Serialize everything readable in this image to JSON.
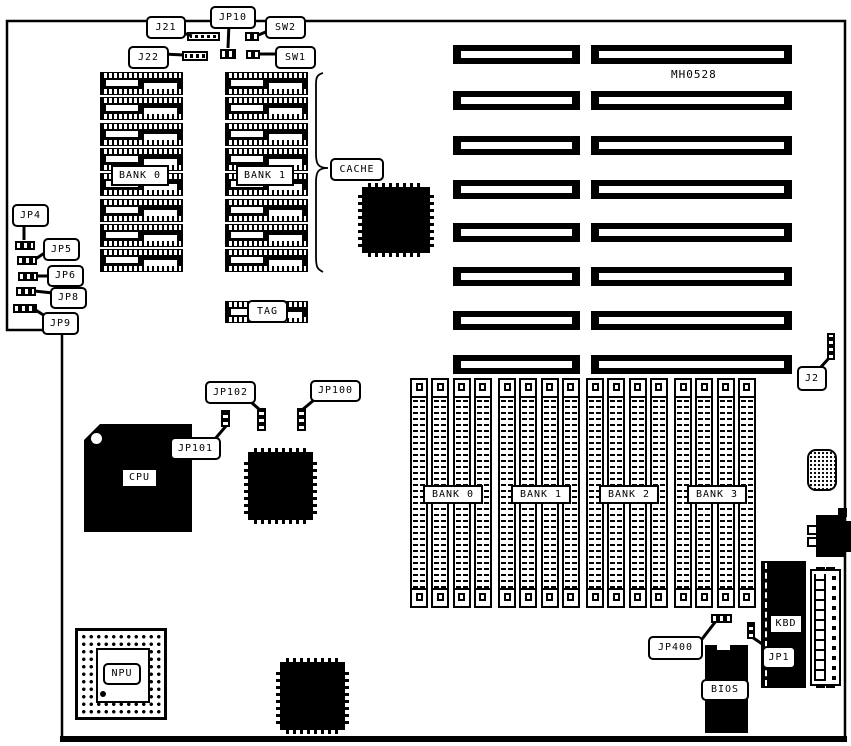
{
  "board": {
    "part_number": "MH0528",
    "callouts": {
      "j21": "J21",
      "jp10": "JP10",
      "sw2": "SW2",
      "j22": "J22",
      "sw1": "SW1",
      "jp4": "JP4",
      "jp5": "JP5",
      "jp6": "JP6",
      "jp8": "JP8",
      "jp9": "JP9",
      "cache": "CACHE",
      "jp102": "JP102",
      "jp100": "JP100",
      "jp101": "JP101",
      "j2": "J2",
      "jp400": "JP400",
      "jp1": "JP1"
    },
    "chip_labels": {
      "cpu": "CPU",
      "npu": "NPU",
      "tag": "TAG",
      "bios": "BIOS",
      "kbd": "KBD"
    },
    "cache_banks": [
      "BANK 0",
      "BANK 1"
    ],
    "memory_banks": [
      "BANK 0",
      "BANK 1",
      "BANK 2",
      "BANK 3"
    ],
    "counts": {
      "expansion_slot_rows": 8,
      "expansion_slot_columns": 2,
      "cache_chip_columns": 2,
      "cache_chips_per_column": 8,
      "memory_bank_count": 4,
      "simm_sockets_per_bank": 4
    }
  }
}
